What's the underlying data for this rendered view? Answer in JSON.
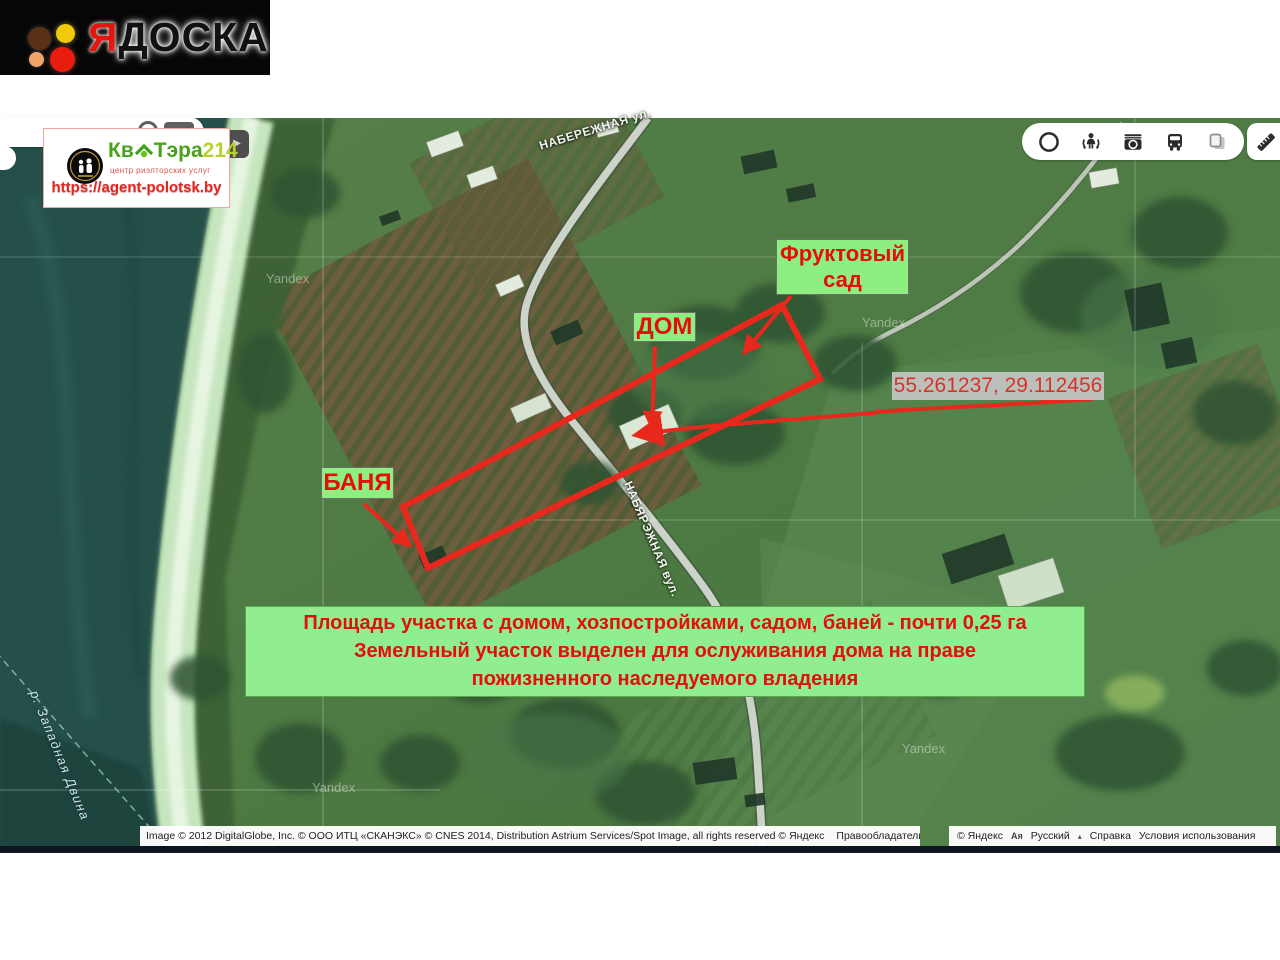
{
  "logo": {
    "first_letter": "Я",
    "rest": "ДОСКА"
  },
  "agency": {
    "name_part1": "Кв",
    "name_part2": "Тэра",
    "name_part3": "214",
    "tagline": "центр риэлторских услуг",
    "url": "https://agent-polotsk.by"
  },
  "map": {
    "street_top": "НАБЕРЕЖНАЯ ул.",
    "street_along_road": "НАБЯРЭЖНАЯ вул.",
    "river_label": "р. Западная Двина",
    "provider_watermark": "Yandex",
    "expand_tab_icon": "▶"
  },
  "annotations": {
    "orchard_label": "Фруктовый сад",
    "house_label": "ДОМ",
    "bath_label": "БАНЯ",
    "coordinates": "55.261237, 29.112456",
    "info_lines": [
      "Площадь участка с домом, хозпостройками, садом, баней - почти 0,25 га",
      "Земельный участок выделен для ослуживания дома на праве",
      "пожизненного наследуемого владения"
    ],
    "accent_color": "#e8281c",
    "label_bg_color": "#8cef80"
  },
  "controls": {
    "icons": [
      "region-circle-icon",
      "panoramas-icon",
      "photos-camera-icon",
      "transport-bus-icon",
      "copy-layers-icon",
      "ruler-icon"
    ]
  },
  "footer": {
    "copyright_text": "Image © 2012 DigitalGlobe, Inc. © ООО ИТЦ «СКАНЭКС» © CNES 2014, Distribution Astrium Services/Spot Image, all rights reserved © Яндекс",
    "rights_link": "Правообладатели",
    "yandex_copyright": "© Яндекс",
    "language_icon": "Aя",
    "language": "Русский",
    "language_caret": "▴",
    "help": "Справка",
    "terms": "Условия использования"
  }
}
